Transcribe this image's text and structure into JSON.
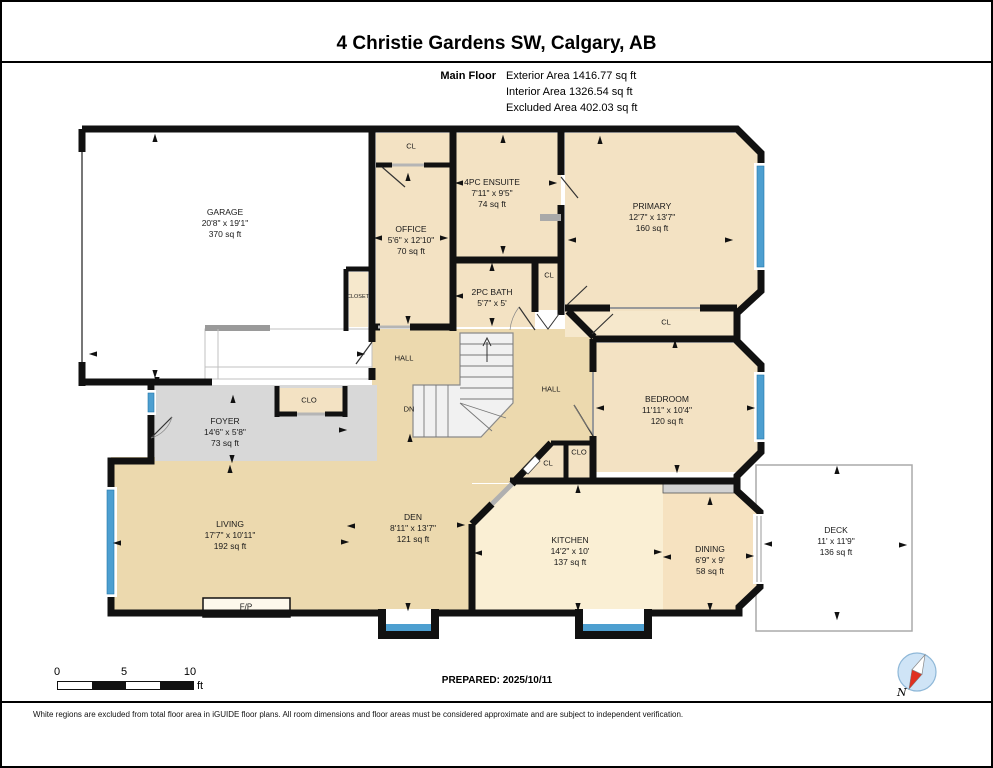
{
  "header": {
    "title": "4 Christie Gardens SW, Calgary, AB",
    "floor_label": "Main Floor",
    "areas": [
      "Exterior Area 1416.77 sq ft",
      "Interior Area 1326.54 sq ft",
      "Excluded Area 402.03 sq ft"
    ]
  },
  "rooms": [
    {
      "name": "GARAGE",
      "dims": "20'8\" x 19'1\"",
      "area": "370 sq ft"
    },
    {
      "name": "OFFICE",
      "dims": "5'6\" x 12'10\"",
      "area": "70 sq ft"
    },
    {
      "name": "4PC ENSUITE",
      "dims": "7'11\" x 9'5\"",
      "area": "74 sq ft"
    },
    {
      "name": "PRIMARY",
      "dims": "12'7\" x 13'7\"",
      "area": "160 sq ft"
    },
    {
      "name": "2PC BATH",
      "dims": "5'7\" x 5'",
      "area": ""
    },
    {
      "name": "BEDROOM",
      "dims": "11'11\" x 10'4\"",
      "area": "120 sq ft"
    },
    {
      "name": "FOYER",
      "dims": "14'6\" x 5'8\"",
      "area": "73 sq ft"
    },
    {
      "name": "LIVING",
      "dims": "17'7\" x 10'11\"",
      "area": "192 sq ft"
    },
    {
      "name": "DEN",
      "dims": "8'11\" x 13'7\"",
      "area": "121 sq ft"
    },
    {
      "name": "KITCHEN",
      "dims": "14'2\" x 10'",
      "area": "137 sq ft"
    },
    {
      "name": "DINING",
      "dims": "6'9\" x 9'",
      "area": "58 sq ft"
    },
    {
      "name": "DECK",
      "dims": "11' x 11'9\"",
      "area": "136 sq ft"
    }
  ],
  "labels": {
    "cl": "CL",
    "clo": "CLO",
    "closet": "CLOSET",
    "hall": "HALL",
    "dn": "DN",
    "fp": "F/P"
  },
  "footer": {
    "scale_ticks": [
      "0",
      "5",
      "10"
    ],
    "scale_unit": "ft",
    "prepared": "PREPARED: 2025/10/11",
    "compass": "N",
    "disclaimer": "White regions are excluded from total floor area in iGUIDE floor plans. All room dimensions and floor areas must be considered approximate and are subject to independent verification."
  },
  "colors": {
    "wall": "#111111",
    "tan": "#ecd9ae",
    "peach": "#f3e2c3",
    "peach_light": "#f6e8cc",
    "cream": "#faefd4",
    "dining": "#f6e2c0",
    "foyer_gray": "#d8d8d8",
    "window_blue": "#4d9fd0",
    "stairs": "#f1f1f1"
  }
}
